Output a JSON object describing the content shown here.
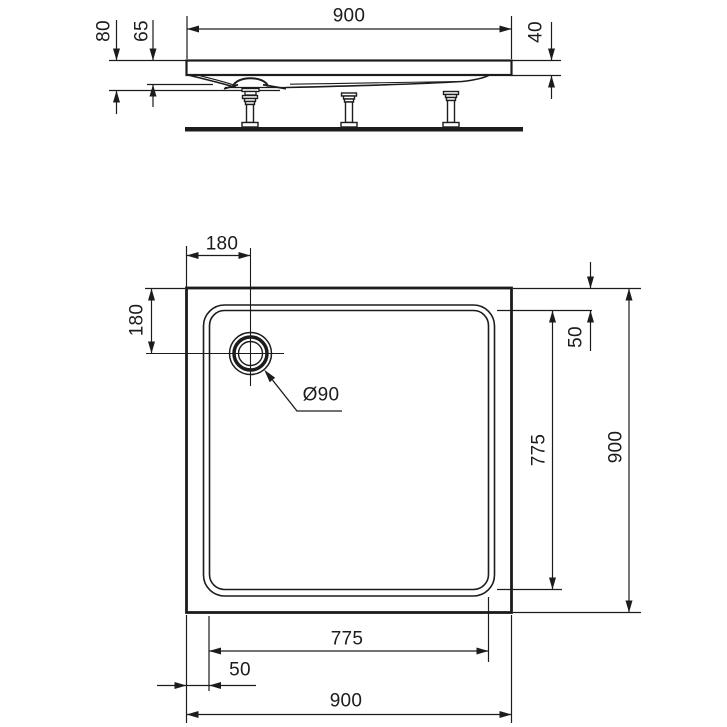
{
  "drawing": {
    "title": "Square shower tray - dimensioned technical drawing",
    "unit": "mm",
    "views": [
      "side elevation",
      "plan view"
    ],
    "line_color": "#1c1c1c",
    "background_color": "#ffffff"
  },
  "dimensions": {
    "side": {
      "overall_width": "900",
      "total_height": "80",
      "body_height": "65",
      "rim_thickness": "40"
    },
    "plan": {
      "drain_offset_top": "180",
      "drain_offset_left": "180",
      "drain_diameter": "Ø90",
      "edge_gap_right": "50",
      "inner_span_right": "775",
      "overall_depth": "900",
      "inner_span_bottom": "775",
      "edge_gap_bottom": "50",
      "overall_width": "900"
    }
  }
}
